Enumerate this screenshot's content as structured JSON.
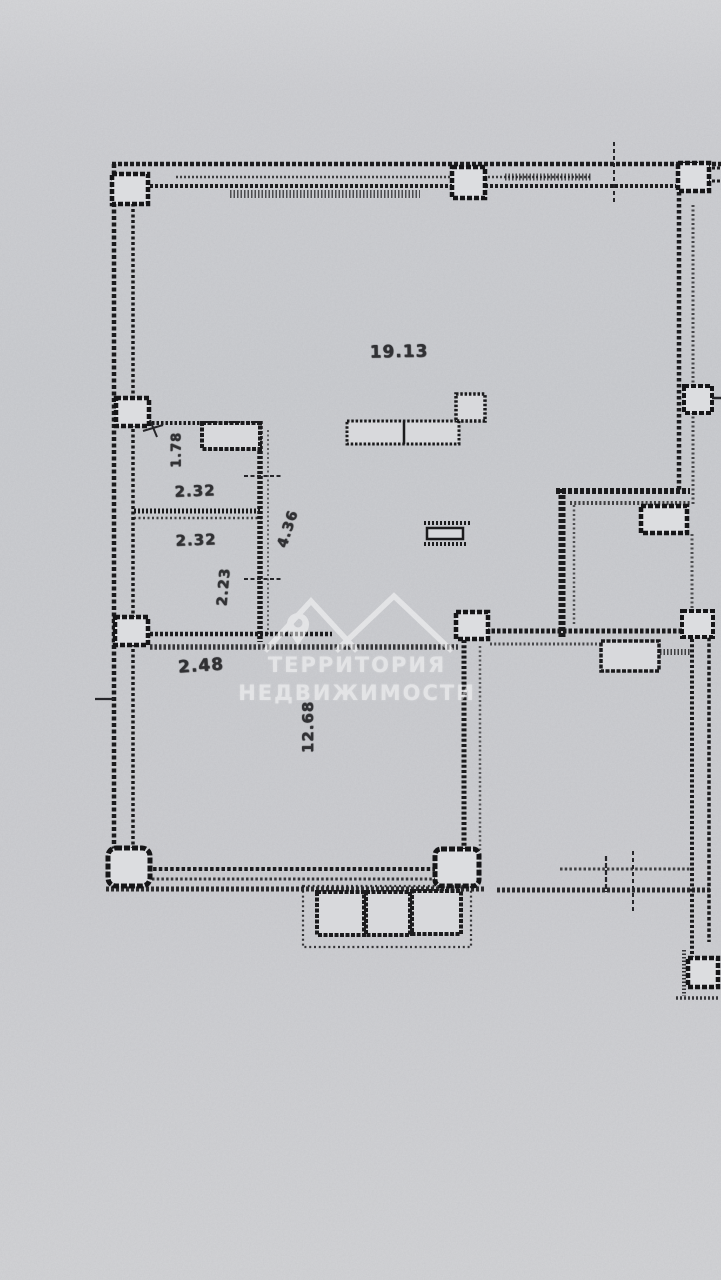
{
  "paper": {
    "background": "#cbccd0",
    "ink": "#1b1b1d"
  },
  "watermark": {
    "logo": "mountains-location-pin",
    "line1": "ТЕРРИТОРИЯ",
    "line2": "НЕДВИЖИМОСТИ",
    "color": "#ffffff"
  },
  "dimensions": {
    "main_room": "19.13",
    "closet_depth": "1.78",
    "closet_width": "2.32",
    "storage_width": "2.32",
    "storage_depth": "2.23",
    "closets_height": "4.36",
    "opening_width": "2.48",
    "lower_room": "12.68"
  }
}
